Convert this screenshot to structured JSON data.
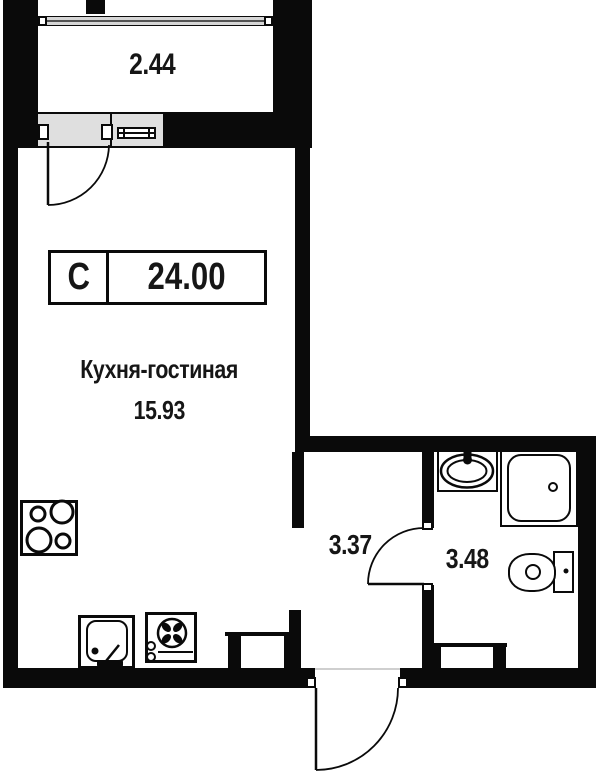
{
  "floorplan": {
    "title": "Studio apartment floor plan",
    "balcony": {
      "area": "2.44"
    },
    "unit_badge": {
      "type": "С",
      "total_area": "24.00"
    },
    "kitchen_living": {
      "name": "Кухня-гостиная",
      "area": "15.93"
    },
    "hallway": {
      "area": "3.37"
    },
    "bathroom": {
      "area": "3.48"
    },
    "fixtures": [
      "stove-4-burner",
      "kitchen-sink",
      "washing-machine",
      "radiator-living",
      "radiator-bathroom",
      "washbasin",
      "shower-tray",
      "toilet",
      "balcony-door",
      "balcony-window",
      "entrance-door",
      "bathroom-door"
    ],
    "colors": {
      "wall": "#0a0a0a",
      "glass_fill": "#dfdfdf",
      "text": "#161616",
      "background": "#ffffff"
    }
  }
}
